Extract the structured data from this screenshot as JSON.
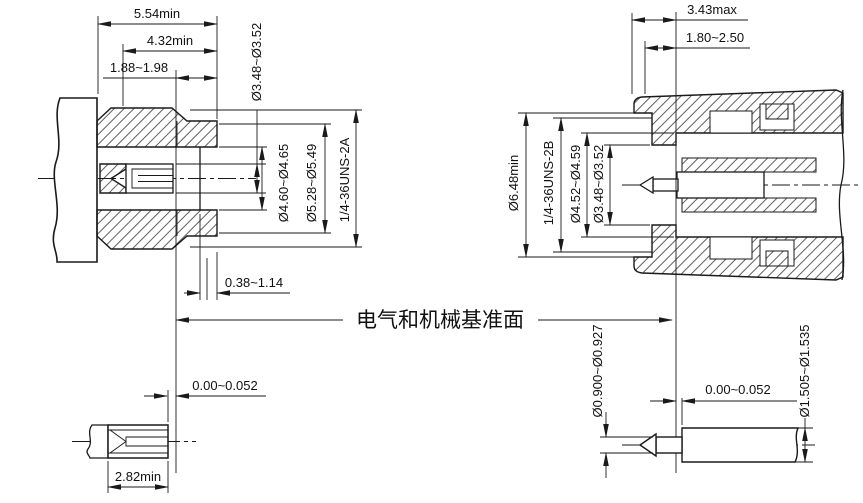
{
  "colors": {
    "line": "#1a1a1a",
    "background": "#ffffff"
  },
  "reference_plane": {
    "label": "电气和机械基准面"
  },
  "left_connector": {
    "dim_overall_length": "5.54min",
    "dim_thread_length": "4.32min",
    "dim_front_to_ref": "1.88~1.98",
    "dim_sleeve_od": "Ø3.48~Ø3.52",
    "dim_bore_id": "Ø4.60~Ø4.65",
    "dim_counterbore_id": "Ø5.28~Ø5.49",
    "thread_spec": "1/4-36UNS-2A",
    "dim_dielectric_recess": "0.38~1.14",
    "dim_contact_setback": "0.00~0.052",
    "dim_socket_depth": "2.82min"
  },
  "right_connector": {
    "dim_front_to_ref_max": "3.43max",
    "dim_engagement": "1.80~2.50",
    "dim_outer_od": "Ø6.48min",
    "thread_spec": "1/4-36UNS-2B",
    "dim_bore_id": "Ø4.52~Ø4.59",
    "dim_sleeve_id": "Ø3.48~Ø3.52",
    "dim_pin_od": "Ø0.900~Ø0.927",
    "dim_pin_setback": "0.00~0.052",
    "dim_shaft_od": "Ø1.505~Ø1.535"
  }
}
